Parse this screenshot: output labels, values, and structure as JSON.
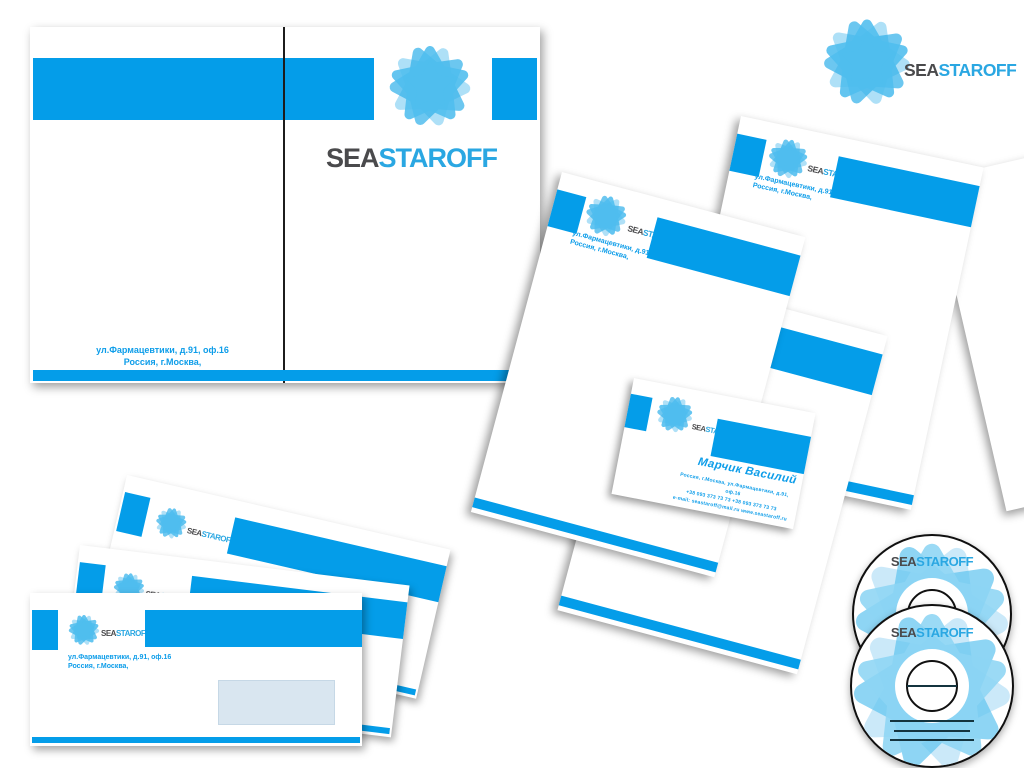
{
  "brand": {
    "name_part1": "SEA",
    "name_part2": "STAROFF",
    "accent_blue": "#049DE9",
    "logo_gray": "#4A4A4C",
    "logo_blue": "#2AA7E2",
    "star_blue_light": "#9BD9F6",
    "star_blue_mid": "#2FB0EA",
    "star_blue_main": "#4FBEEF"
  },
  "company": {
    "address_line1": "ул.Фармацевтики, д.91, оф.16",
    "address_line2": "Россия, г.Москва,"
  },
  "business_card": {
    "person_name": "Марчик Василий",
    "contact_line1": "Россия, г.Москва, ул.Фармацевтики, д.91, оф.16",
    "contact_line2": "+38 093 373 73 73   +38 093 373 73 73",
    "contact_line3": "e-mail: seastaroff@mail.ru   www.seastaroff.ru"
  }
}
